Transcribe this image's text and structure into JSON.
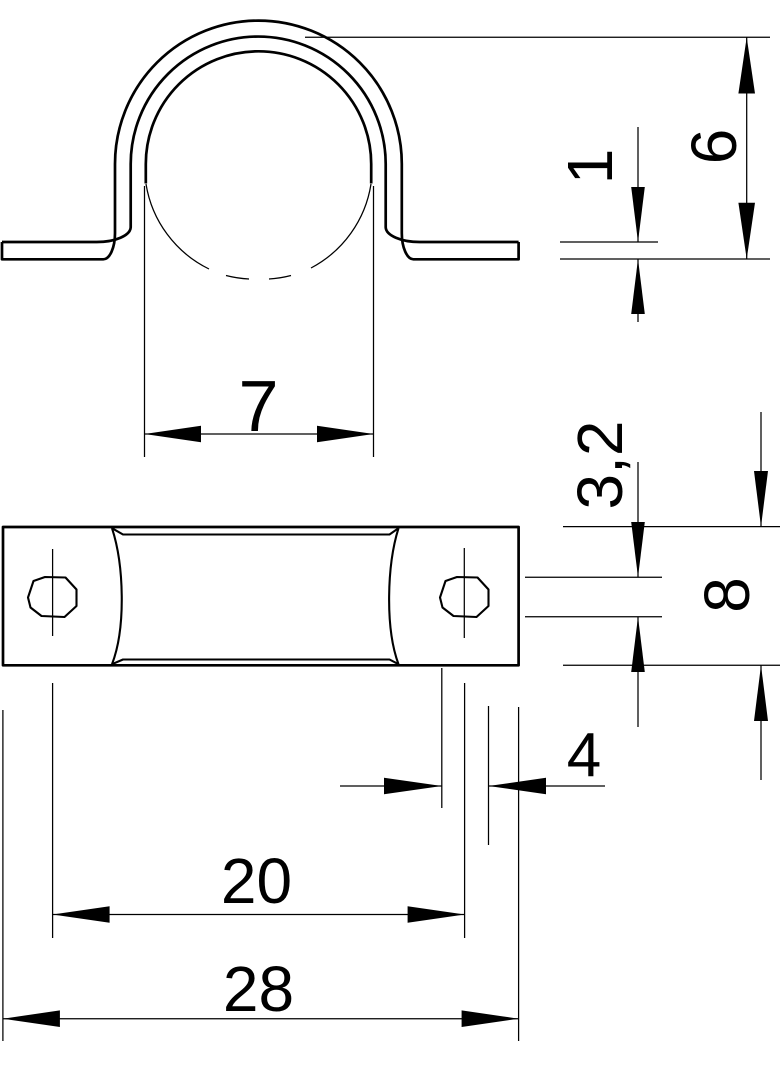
{
  "drawing": {
    "background": "#ffffff",
    "line_color": "#000000"
  },
  "dimensions": {
    "clamp_inner_width": {
      "label": "7"
    },
    "material_thickness": {
      "label": "1"
    },
    "clamp_height": {
      "label": "6"
    },
    "hole_length": {
      "label": "3,2"
    },
    "plate_width": {
      "label": "8"
    },
    "hole_width": {
      "label": "4"
    },
    "hole_spacing": {
      "label": "20"
    },
    "overall_length": {
      "label": "28"
    }
  }
}
